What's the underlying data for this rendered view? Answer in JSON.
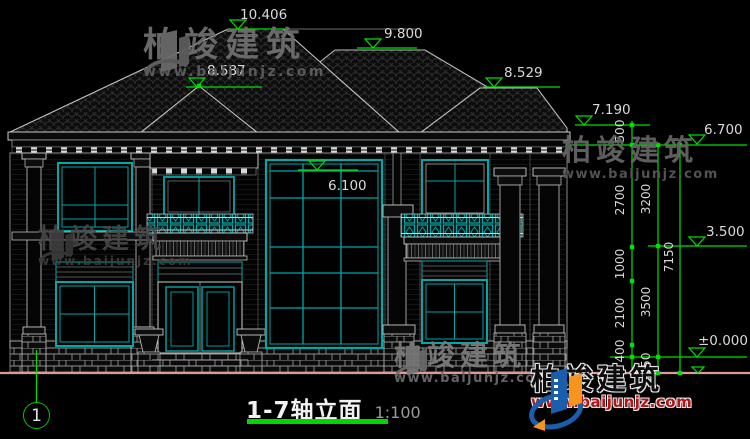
{
  "title": {
    "label": "1-7轴立面",
    "scale": "1:100"
  },
  "axis": {
    "bubble": "1"
  },
  "watermark": {
    "brand": "柏竣建筑",
    "url": "www.baijunjz.com"
  },
  "logo": {
    "brand": "柏竣建筑",
    "url": "www.baijunjz.com"
  },
  "elevations": {
    "e10406": "10.406",
    "e9800": "9.800",
    "e8587": "8.587",
    "e8529": "8.529",
    "e7190": "7.190",
    "e6700": "6.700",
    "e6100": "6.100",
    "e3500": "3.500",
    "e0": "±0.000"
  },
  "dims": {
    "col1": [
      "500",
      "2700",
      "1000",
      "2100",
      "400"
    ],
    "col2": [
      "3200",
      "3500",
      "450"
    ],
    "col3": [
      "7150"
    ]
  },
  "colors": {
    "dimension_green": "#00E000",
    "window_teal": "#00A8A8",
    "ground_pink": "#E09999",
    "line_gray": "#C8C8C8",
    "roof_hatch": "#2E2E2E",
    "logo_blue": "#1B5EAC",
    "logo_orange": "#F7941E",
    "url_red": "#B41414"
  }
}
